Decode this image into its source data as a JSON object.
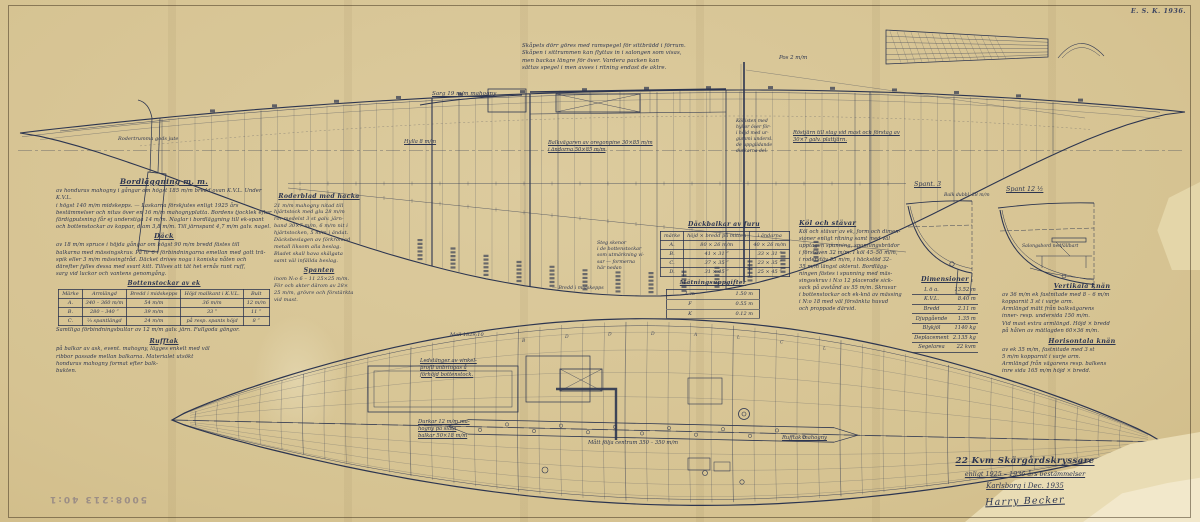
{
  "meta": {
    "stamp": "E. S. K. 1936.",
    "accession": "5008:213  40:1"
  },
  "title_block": {
    "line1": "22 Kvm Skärgårdskryssare",
    "line2": "enligt 1925 – 1936 års bestämmelser",
    "line3": "Karlsborg i Dec. 1935",
    "signature": "Harry Becker"
  },
  "top_note": {
    "lines": [
      "Skåpets dörr göres med ramspegel för sittbrädd i förrum.",
      "Skåpen i sittrummen kan flyttas in i salongen som visas,",
      "men backas längre för över.  Vardera packen kan",
      "sättas spegel i men avses i ritning endast de aktre."
    ]
  },
  "bordlaggning": {
    "heading": "Bordläggning m. m.",
    "lines": [
      "av honduras mahogny i gångar om högst 185 m/m bredd ovan K.V.L.  Under K.V.L.",
      "i högst 140 m/m midskepps. — Laskarna förskjutes enligt 1925 års",
      "bestämmelser och nitas över en 16 m/m mahognyplatta.  Bordens tjocklek efter",
      "färdigputsning får ej understiga 14 m/m.   Naglar i bordläggning till ek-spant",
      "och bottenstockar av koppar, diam 3,8 m/m.  Till järnspant 4,7 m/m galv. nagel."
    ],
    "subheading": "Däck",
    "dack_lines": [
      "av 18 m/m spruce i höjda gångar om högst 90 m/m bredd fästes till",
      "balkarna med mässingskruv.  På nr 6 i förbindningarna emellan med gott trä-",
      "spik eller 3 m/m mässingtråd.   Däcket drives noga i koniska nåten och",
      "därefter fylles dessa med svart kitt.  Tillses att tät het ernås runt ruff,",
      "sarg vid luckor och vantens genomgång."
    ]
  },
  "bottenstockar": {
    "title": "Bottenstockar av ek",
    "headers": [
      "Märke",
      "Armlängd",
      "Bredd i midskepps",
      "Höjd mallkant i K.V.L.",
      "Bult"
    ],
    "rows": [
      [
        "A.",
        "340 – 360 m/m",
        "54 m/m",
        "36 m/m",
        "12 m/m"
      ],
      [
        "B.",
        "280 – 340  ”",
        "39 m/m",
        "33  ”",
        "11  ”"
      ],
      [
        "C.",
        "⅔ spantlängd",
        "24 m/m",
        "på resp. spants höjd",
        "8  ”"
      ]
    ],
    "note": "Samtliga förbindningsbultar av 12 m/m galv. järn.  Fullgoda gängor."
  },
  "rufftak": {
    "heading": "Rufftak",
    "lines": [
      "på balkar av ask, event. mahogny, lägges enkelt med väl",
      "ribbor passade mellan balkarna.  Materialet utsökt",
      "honduras mahogny format efter balk-",
      "bukten."
    ]
  },
  "roderblad": {
    "heading": "Roderblad med hacka",
    "lines": [
      "21 m/m mahogny nitad till",
      "hjärtstock med glu 28 m/m",
      "rör medelst 3 st galv. järn-",
      "band 30×7 m/m,  6 m/m nit i",
      "hjärtstocken,  5 m/m i ändat.",
      "Däcksbeslagen av förkromad",
      "metall liksom alla beslag.",
      "Bladet skall hava skälgata",
      "samt väl infällda beslag."
    ],
    "subheading": "Spanten",
    "spant_lines": [
      "inom N:o 6 – 11   25×25 m/m.",
      "För och akter därom av 28×",
      "25 m/m, grövre och förstärkta",
      "vid mast."
    ]
  },
  "dackbalkar": {
    "title": "Däckbalkar av furu",
    "headers": [
      "märke",
      "höjd × bredd på mitten",
      "i ändarna"
    ],
    "rows": [
      [
        "A.",
        "80 × 26 m/m",
        "40 × 26 m/m"
      ],
      [
        "B.",
        "41 × 31   ”",
        "33 × 31  ”"
      ],
      [
        "C.",
        "37 × 35   ”",
        "23 × 35  ”"
      ],
      [
        "D.",
        "31 × 45   ”",
        "25 × 45  ”"
      ]
    ]
  },
  "matning": {
    "title": "Mätningsuppgifter",
    "rows": [
      [
        "L m",
        "1.50 m"
      ],
      [
        "F",
        "0.55 m"
      ],
      [
        "K",
        "0.12 m"
      ]
    ]
  },
  "kol_stavar": {
    "heading": "Köl och stävar",
    "lines": [
      "Köl och stävar av ek, form och dimen-",
      "sioner enligt ritning samt med väl",
      "upptagen spunning, spunningsbrädor",
      "i förstäven 32 m/m.  I köl 45–50 m/m,",
      "i roderstäv 55 m/m, i häckstöd 32–",
      "35 m/m längst akterut.   Bordlägg-",
      "ningen fästes i spunning med mäs-",
      "singsskruv i N:o 12 placerade sick-",
      "sack på avstånd av 55 m/m.  Skruvar",
      "i bottenstockar och ek-knä av mässing",
      "i N:o 18 med väl försänkta huvud",
      "och proppade därvid."
    ]
  },
  "dimensioner": {
    "title": "Dimensioner",
    "rows": [
      [
        "L ö a.",
        "13.52 m"
      ],
      [
        "K.V.L.",
        "8.40 m"
      ],
      [
        "Bredd",
        "2.11 m"
      ],
      [
        "Djupgående",
        "1.35 m"
      ],
      [
        "Blykjöl",
        "1140 kg"
      ],
      [
        "Deplacement",
        "2.135 kg"
      ],
      [
        "Segelarea",
        "22 kvm"
      ]
    ]
  },
  "vertikala_knan": {
    "heading": "Vertikala knän",
    "lines": [
      "av 36 m/m ek fastnitade med 8 – 6 m/m",
      "kopparnit 3 st i varje arm.",
      "Armlängd mätt från balkvägarens",
      "inner- resp. undersida 150 m/m.",
      "Vid mast extra armlängd.  Höjd × bredd",
      "på hålen av mätlagden  60×36 m/m."
    ]
  },
  "horisontala_knan": {
    "heading": "Horisontala knän",
    "lines": [
      "av ek 35 m/m, fastnitade med 3 st",
      "5 m/m kopparnit i varje arm.",
      "Armlängd från vägarens resp. balkens",
      "inre sida 165 m/m höjd × bredd."
    ]
  },
  "plan_frame_letters": [
    "B",
    "D",
    "D",
    "D",
    "A",
    "L",
    "C",
    "L"
  ],
  "annotations": [
    {
      "id": "rodertrumma",
      "x": 118,
      "y": 136,
      "fs": 5,
      "lines": [
        "Rodertrumma gods jute"
      ]
    },
    {
      "id": "sarg",
      "x": 432,
      "y": 91,
      "fs": 5.6,
      "u": true,
      "lines": [
        "Sarg 19 m/m mahogny"
      ]
    },
    {
      "id": "hylla",
      "x": 404,
      "y": 139,
      "fs": 5.2,
      "u": true,
      "lines": [
        "Hylla 8 m/m"
      ]
    },
    {
      "id": "balkvagare",
      "x": 548,
      "y": 140,
      "fs": 5.2,
      "u": true,
      "lines": [
        "Balkvägaren av oregonpine 30×85 m/m",
        "   i ändarna 50×85 m/m"
      ]
    },
    {
      "id": "rostjarn",
      "x": 793,
      "y": 130,
      "fs": 5.2,
      "u": true,
      "lines": [
        "Röstjärn till stag vid mast och förstag av",
        "  30×7  galv. plattjärn."
      ]
    },
    {
      "id": "pos",
      "x": 779,
      "y": 55,
      "fs": 5.4,
      "lines": [
        "Pos  2 m/m"
      ]
    },
    {
      "id": "mast-note",
      "x": 736,
      "y": 119,
      "fs": 4.6,
      "lines": [
        "Köllisten med",
        "hyllor över för-",
        "i höjd med ur-",
        "gummi undersl.",
        "de uppglidande",
        "durkarna del."
      ]
    },
    {
      "id": "spant3",
      "x": 914,
      "y": 180,
      "fs": 6.4,
      "u": true,
      "lines": [
        "Spant. 3"
      ]
    },
    {
      "id": "spant12",
      "x": 1006,
      "y": 185,
      "fs": 6.4,
      "u": true,
      "lines": [
        "Spant 12 ½"
      ]
    },
    {
      "id": "balk-dubbel",
      "x": 944,
      "y": 193,
      "fs": 4.6,
      "lines": [
        "Balk dubbl. 28 m/m"
      ]
    },
    {
      "id": "salongsbord",
      "x": 1022,
      "y": 244,
      "fs": 4.6,
      "lines": [
        "Salongsbord nedfällbart"
      ]
    },
    {
      "id": "stegskenor",
      "x": 597,
      "y": 241,
      "fs": 4.8,
      "lines": [
        "Steg skenor",
        "i de bottenstockar",
        "som utmärkning vi-",
        "sar — formerna",
        "här nedan"
      ]
    },
    {
      "id": "bredd-midskepps",
      "x": 552,
      "y": 286,
      "fs": 4.8,
      "lines": [
        "—  Bredd i midskepps"
      ]
    },
    {
      "id": "mall",
      "x": 450,
      "y": 332,
      "fs": 5,
      "lines": [
        "Mall 1829:10"
      ]
    },
    {
      "id": "ledstanger",
      "x": 420,
      "y": 358,
      "fs": 5.2,
      "u": true,
      "lines": [
        "Ledstänger av vinkel-",
        "profil anbringas å",
        "förhöjd bottenstock."
      ]
    },
    {
      "id": "durkar",
      "x": 418,
      "y": 419,
      "fs": 5.2,
      "u": true,
      "lines": [
        "Durkar 12 m/m ma-",
        "hogny på släta",
        "balkar 50×18 m/m"
      ]
    },
    {
      "id": "matt-centrum",
      "x": 588,
      "y": 440,
      "fs": 5.2,
      "lines": [
        "Mått följa centrum 350 – 350 m/m"
      ]
    },
    {
      "id": "rufftak-label",
      "x": 782,
      "y": 435,
      "fs": 5.2,
      "u": true,
      "lines": [
        "Rufftak mahogny"
      ]
    }
  ]
}
